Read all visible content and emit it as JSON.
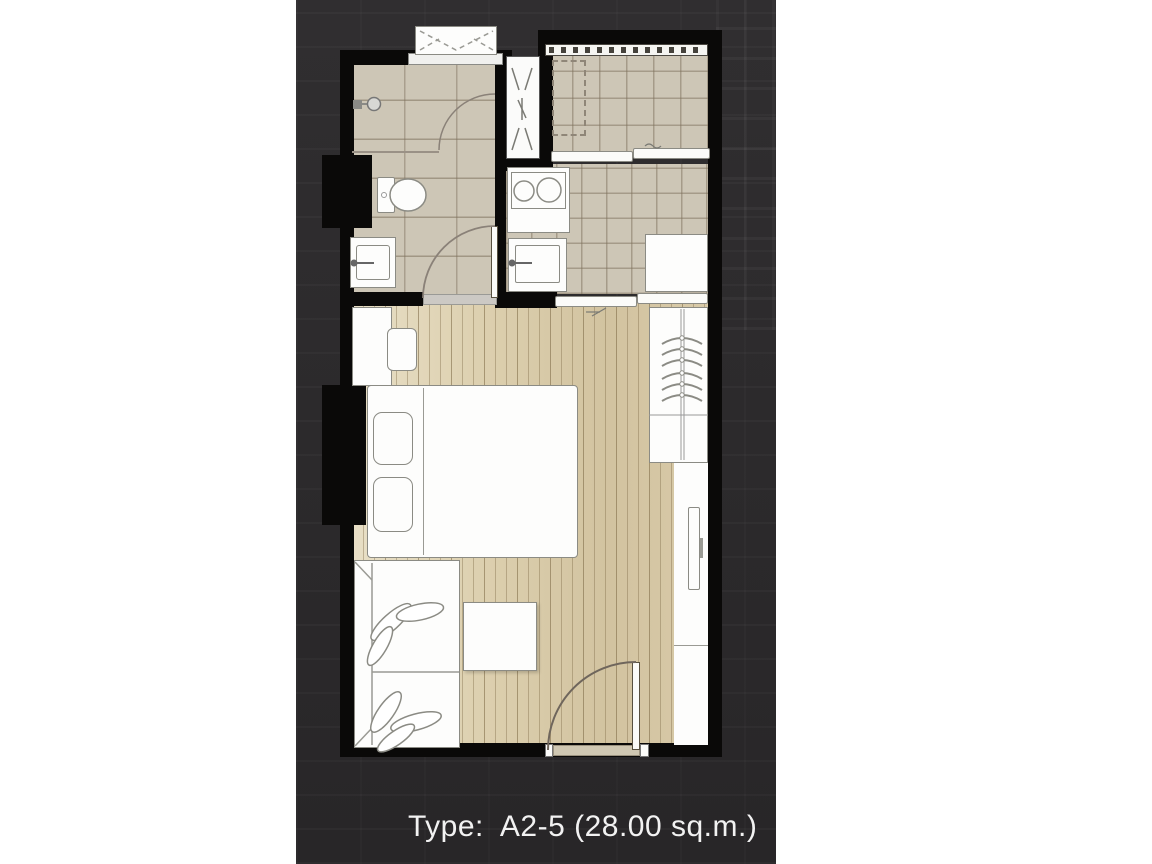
{
  "caption": {
    "label": "Type:  A2-5 (28.00 sq.m.)",
    "unit_type": "A2-5",
    "area_sqm": "28.00"
  },
  "colors": {
    "panel": "#2b292b",
    "wall": "#0a0908",
    "tile": "#cdc6b6",
    "tile_line": "#b1a795",
    "wood_light": "#e8dfc6",
    "wood_dark": "#d2c3a0",
    "furniture": "#fdfdfc",
    "outline": "#8b8b84",
    "caption_text": "#f2f2f2",
    "threshold": "#cfc7b2"
  },
  "plan": {
    "type": "studio-condominium-floor-plan",
    "rooms": [
      {
        "name": "bathroom",
        "features": [
          "shower",
          "toilet",
          "wash-basin",
          "swing-door"
        ]
      },
      {
        "name": "balcony",
        "features": [
          "railing",
          "washer-space",
          "floor-drain",
          "sliding-door"
        ]
      },
      {
        "name": "kitchen",
        "features": [
          "two-burner-stove",
          "kitchen-sink",
          "refrigerator",
          "sliding-door"
        ]
      },
      {
        "name": "living-sleeping-area",
        "features": [
          "desk",
          "stool",
          "double-bed",
          "wardrobe",
          "tv",
          "sofa-with-plant",
          "coffee-table",
          "entrance-door"
        ]
      }
    ],
    "services": [
      "ac-condenser-unit",
      "pipe-shaft"
    ]
  }
}
